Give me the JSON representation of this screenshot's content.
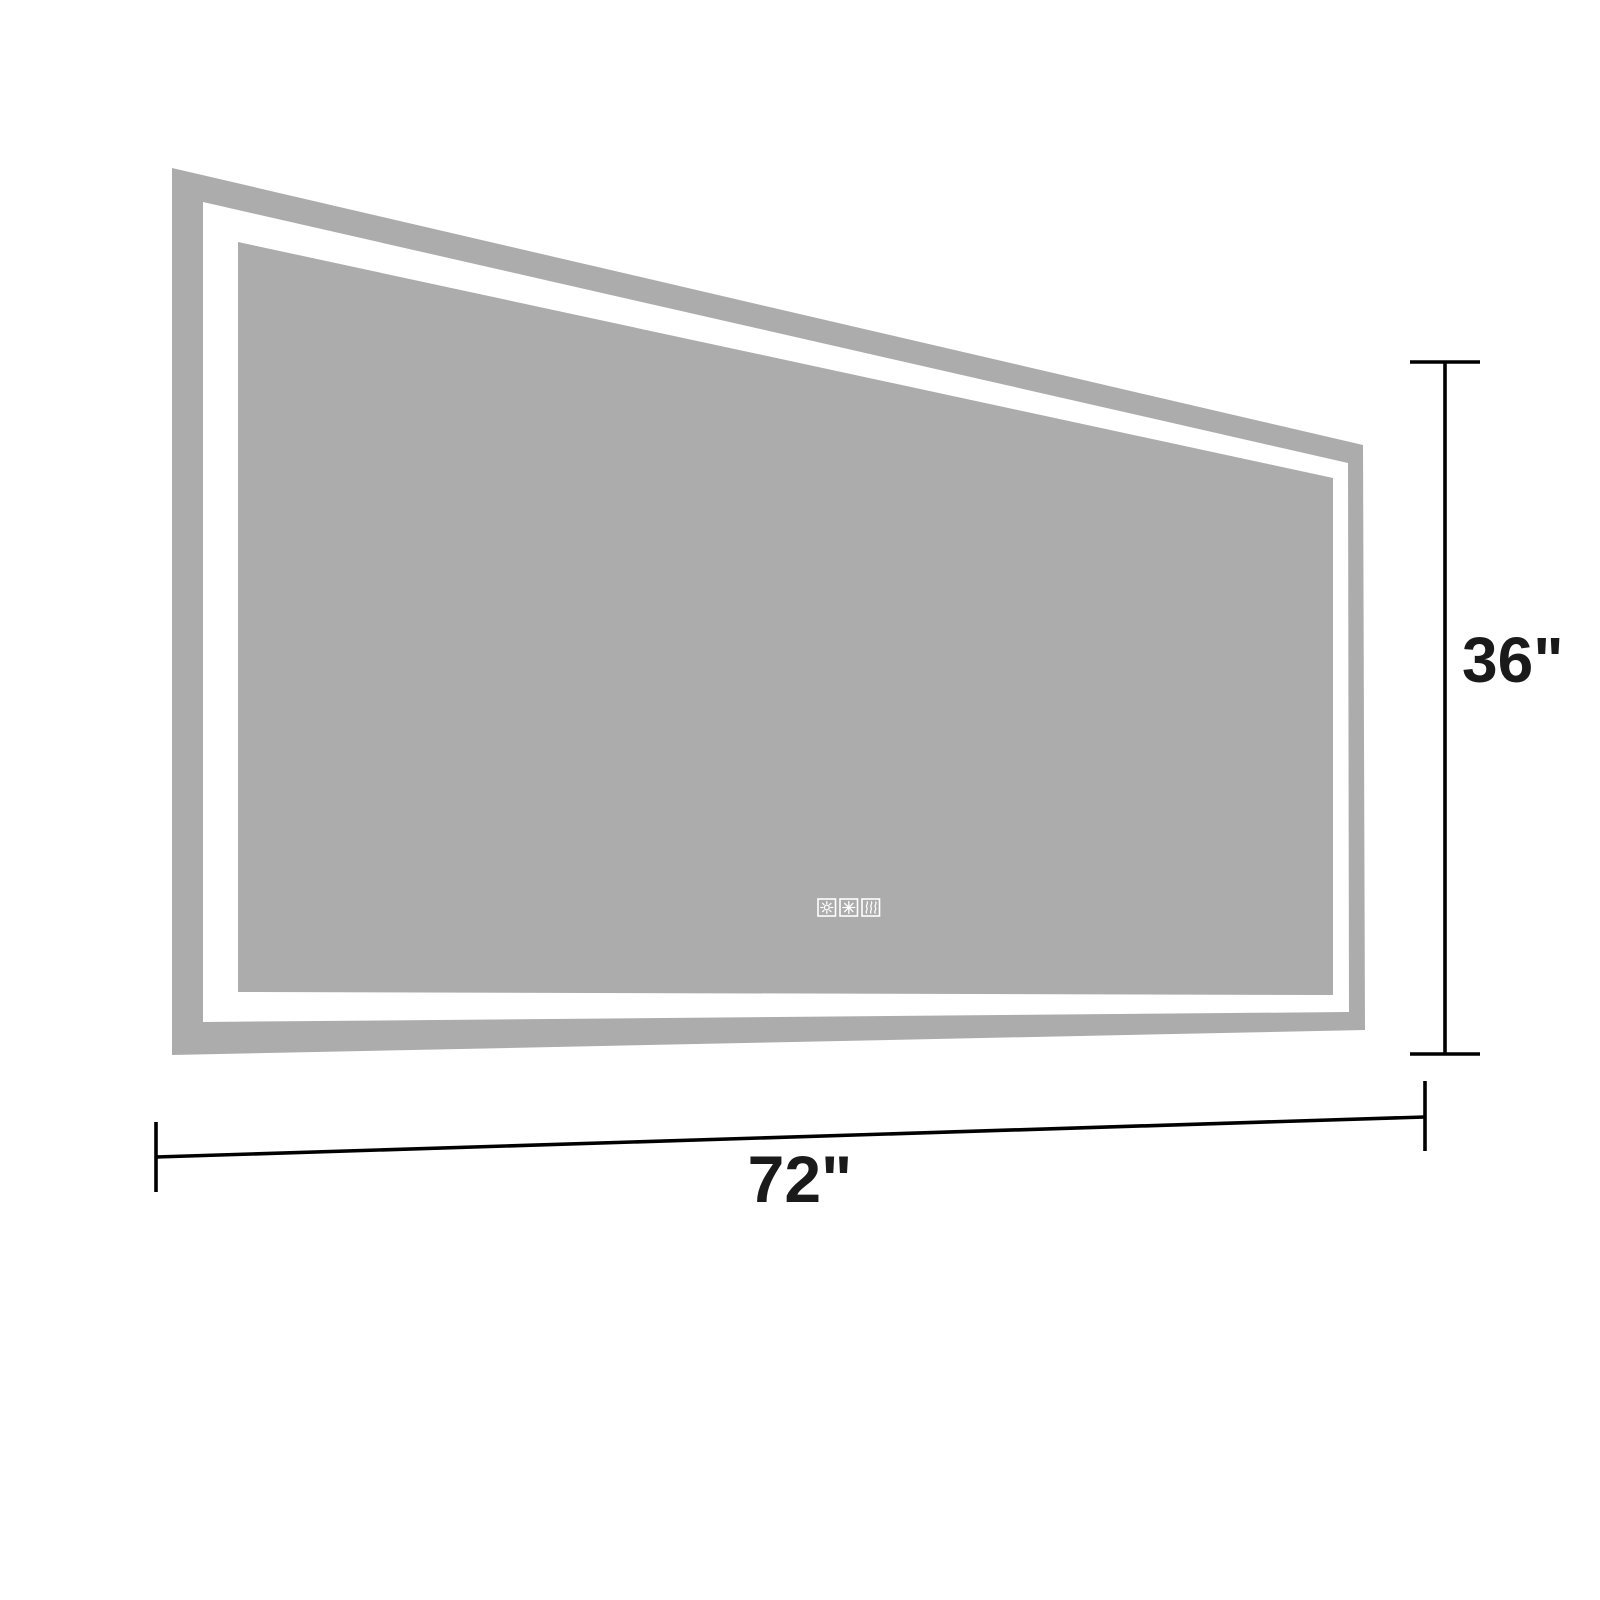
{
  "diagram": {
    "title": "led-mirror-dimension-diagram",
    "dimensions": {
      "width": {
        "label": "72\"",
        "value": 72,
        "unit": "inch"
      },
      "height": {
        "label": "36\"",
        "value": 36,
        "unit": "inch"
      }
    },
    "touch_buttons": [
      {
        "name": "brightness",
        "icon": "sun-icon"
      },
      {
        "name": "color-temperature",
        "icon": "snowflake-icon"
      },
      {
        "name": "defog",
        "icon": "wave-icon"
      }
    ],
    "colors": {
      "frame_gray": "#acacac",
      "mirror_gray": "#acacac",
      "led_band_white": "#ffffff",
      "background": "#ffffff",
      "dimension_line": "#000000",
      "label_text": "#1a1a1a"
    }
  }
}
